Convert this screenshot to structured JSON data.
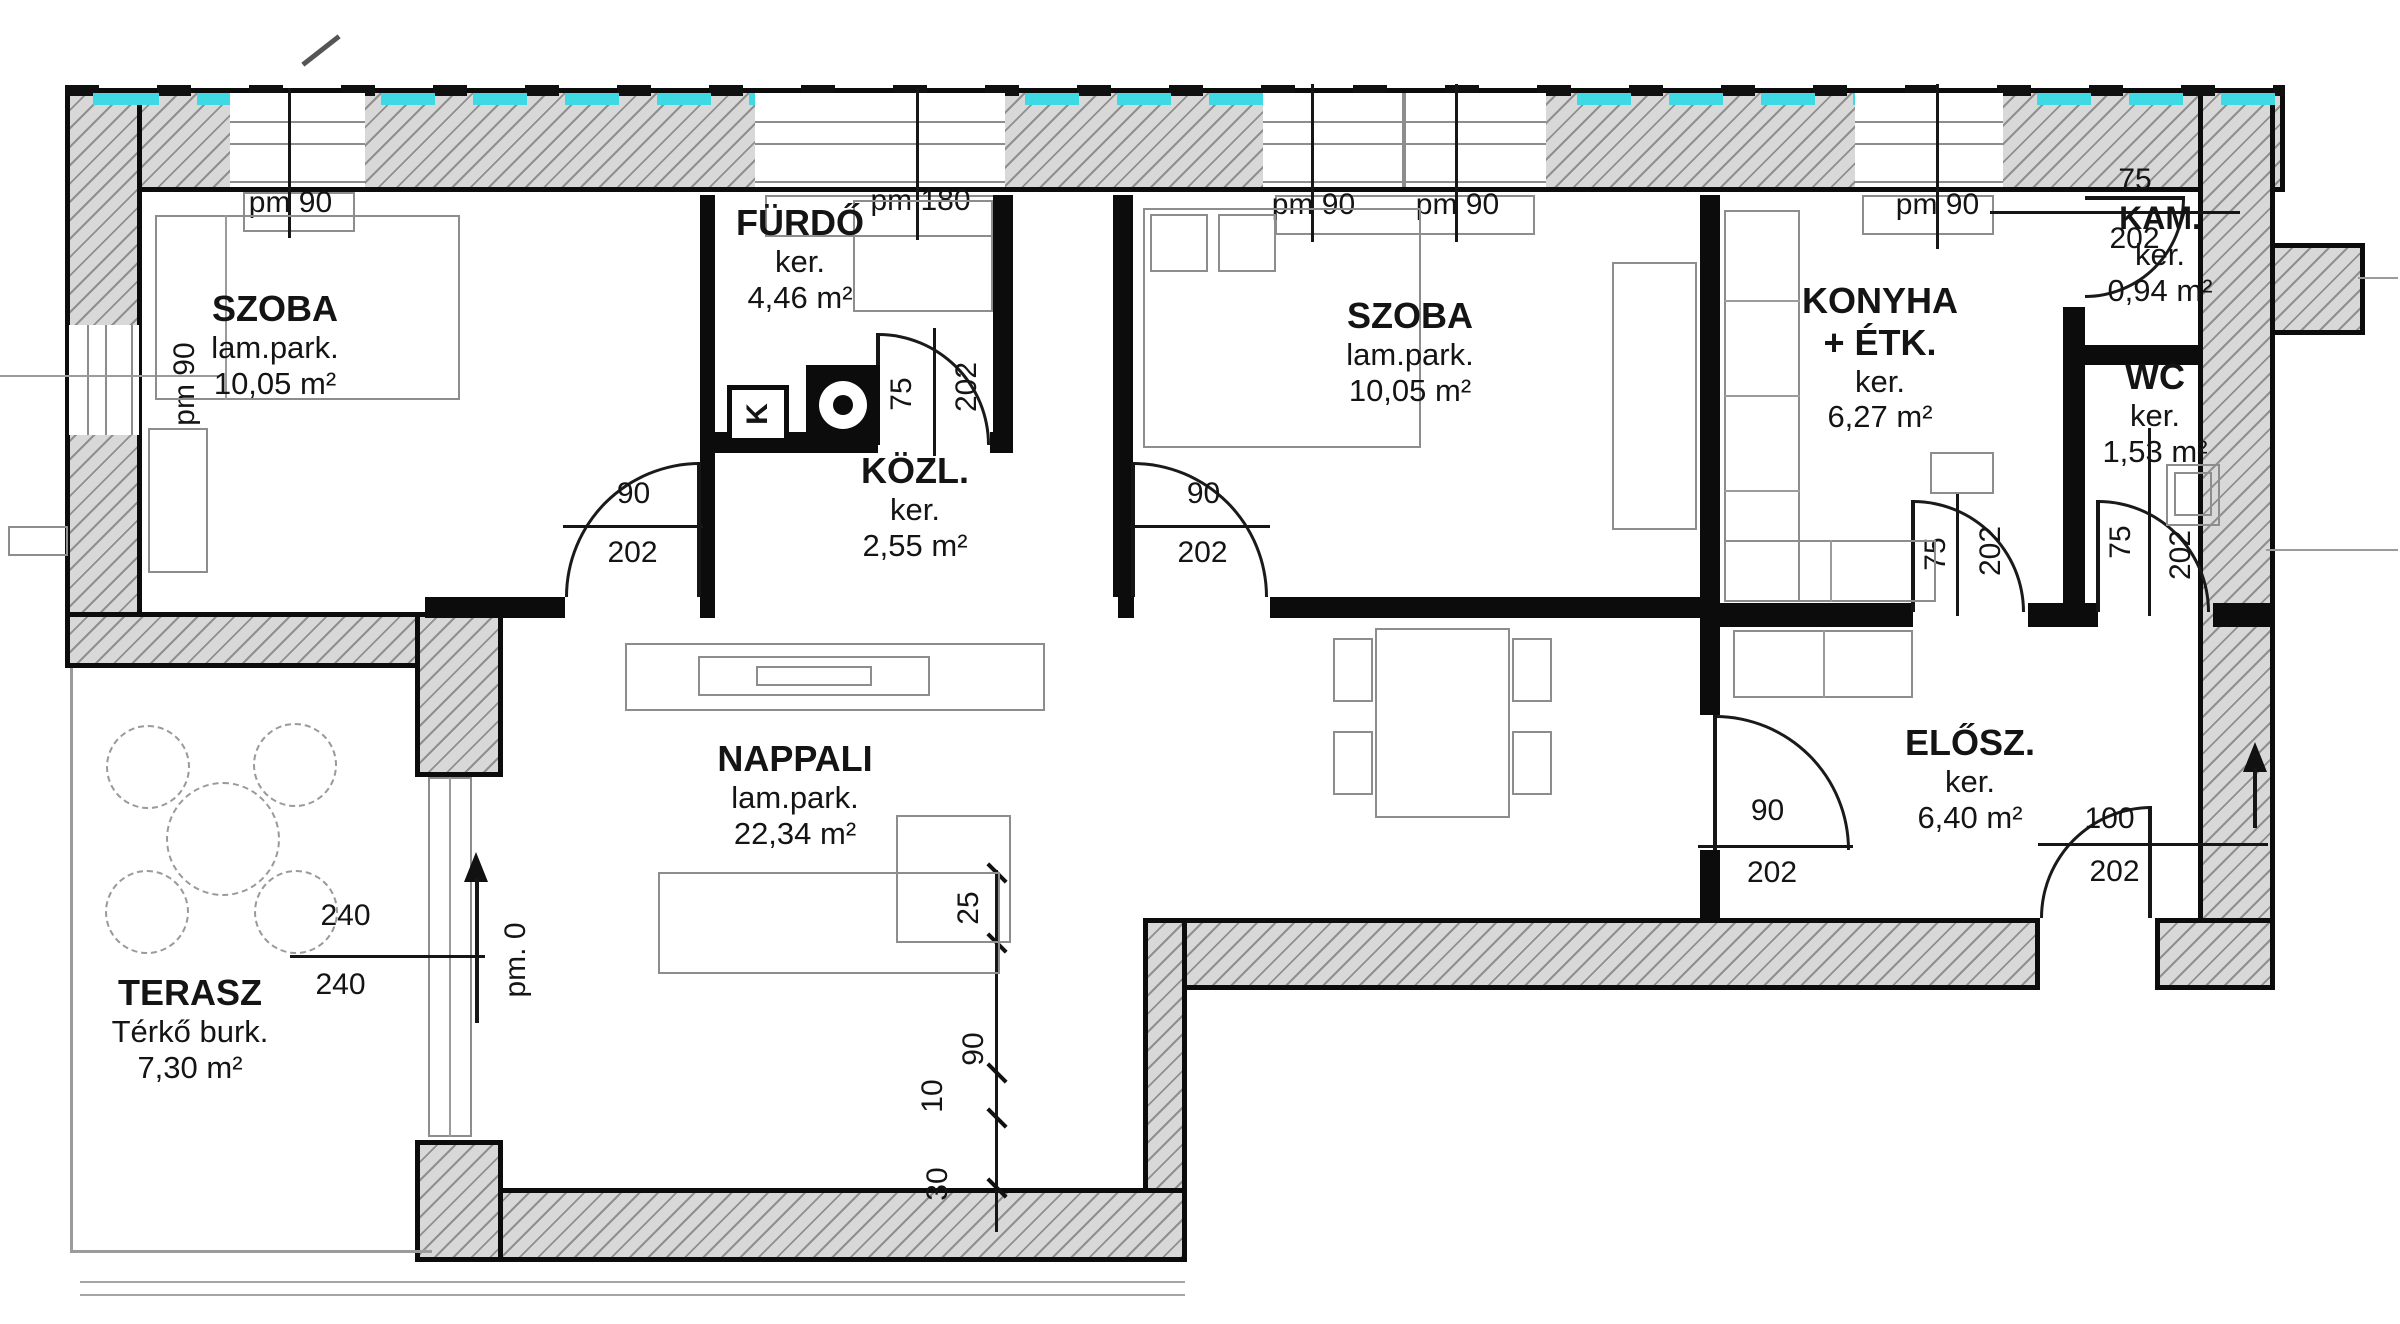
{
  "rooms": {
    "szoba1": {
      "name": "SZOBA",
      "floor": "lam.park.",
      "area": "10,05 m²"
    },
    "furdo": {
      "name": "FÜRDŐ",
      "floor": "ker.",
      "area": "4,46 m²"
    },
    "kozl": {
      "name": "KÖZL.",
      "floor": "ker.",
      "area": "2,55 m²"
    },
    "szoba2": {
      "name": "SZOBA",
      "floor": "lam.park.",
      "area": "10,05 m²"
    },
    "konyha": {
      "name": "KONYHA",
      "name2": "+ ÉTK.",
      "floor": "ker.",
      "area": "6,27 m²"
    },
    "kam": {
      "name": "KAM.",
      "floor": "ker.",
      "area": "0,94 m²"
    },
    "wc": {
      "name": "WC",
      "floor": "ker.",
      "area": "1,53 m²"
    },
    "nappali": {
      "name": "NAPPALI",
      "floor": "lam.park.",
      "area": "22,34 m²"
    },
    "elosz": {
      "name": "ELŐSZ.",
      "floor": "ker.",
      "area": "6,40 m²"
    },
    "terasz": {
      "name": "TERASZ",
      "floor": "Térkő burk.",
      "area": "7,30 m²"
    }
  },
  "windows": {
    "w1": "pm 90",
    "w2": "pm 180",
    "w3a": "pm 90",
    "w3b": "pm 90",
    "w4": "pm 90",
    "left": "pm 90"
  },
  "doors": {
    "szoba1": {
      "w": "90",
      "h": "202"
    },
    "szoba2": {
      "w": "90",
      "h": "202"
    },
    "furdo": {
      "w": "75",
      "h": "202"
    },
    "kam": {
      "w": "75",
      "h": "202"
    },
    "konyha": {
      "w": "75",
      "h": "202"
    },
    "wc": {
      "w": "75",
      "h": "202"
    },
    "elosz": {
      "w": "90",
      "h": "202"
    },
    "entrance": {
      "w": "100",
      "h": "202"
    },
    "terasz": {
      "w": "240",
      "h": "240"
    }
  },
  "annotations": {
    "level": "pm. 0",
    "k_box": "K",
    "chain": {
      "d25": "25",
      "d90": "90",
      "d10": "10",
      "d30": "30"
    }
  },
  "colors": {
    "insulation": "#3FD9E3",
    "wall_fill": "#D8D8D8",
    "line": "#111111"
  }
}
